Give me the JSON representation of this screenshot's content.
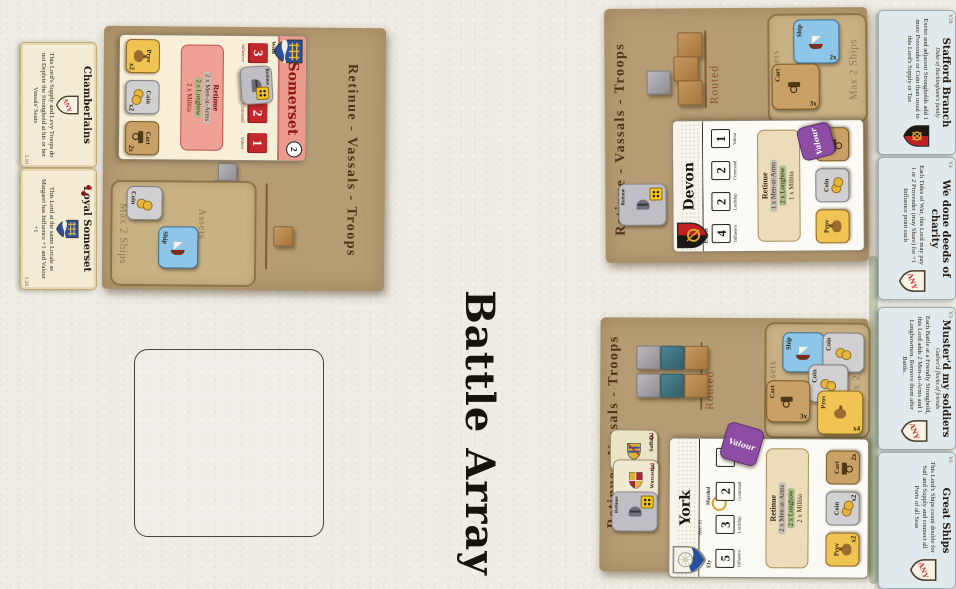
{
  "board": {
    "title": "Battle Array"
  },
  "shared": {
    "mat_header": "Retinue - Vassals - Troops",
    "routed": "Routed",
    "assets": "Assets",
    "max_ships": "Max 2 Ships",
    "stat_labels": [
      "Influence",
      "Lordship",
      "Command",
      "Valour"
    ],
    "retinue_label": "Retinue",
    "valour_label": "Valour"
  },
  "somerset": {
    "card": {
      "name": "Somerset",
      "seat": "Wells",
      "badge": "2",
      "stats": {
        "influence": "3",
        "command": "2",
        "valour": "1"
      },
      "retinue": [
        "2 x Men-at-Arms",
        "2 x Longbow",
        "2 x Militia"
      ],
      "tokens": [
        {
          "label": "Prov",
          "mult": "x2"
        },
        {
          "label": "Coin",
          "mult": "x2"
        },
        {
          "label": "Cart",
          "mult": "2x"
        }
      ]
    },
    "assets_tokens": [
      {
        "label": "Coin"
      },
      {
        "label": "Ship"
      }
    ]
  },
  "devon": {
    "card": {
      "name": "Devon",
      "seat": "Exeter",
      "stats": {
        "influence": "4",
        "lordship": "2",
        "command": "2",
        "valour": "1"
      },
      "retinue": [
        "1 x Men-at-Arms",
        "2 x Longbow",
        "1 x Militia"
      ],
      "tokens": [
        {
          "label": "Prov"
        },
        {
          "label": "Coin"
        },
        {
          "label": "Cart"
        }
      ]
    },
    "assets_tokens": [
      {
        "label": "Ship",
        "mult": "2x"
      },
      {
        "label": "Cart",
        "mult": "3x"
      }
    ]
  },
  "york": {
    "card": {
      "name": "York",
      "heir": "Heir #1",
      "seat": "Ely",
      "marshal": "Marshal",
      "stats": {
        "influence": "5",
        "lordship": "3",
        "command": "2"
      },
      "retinue": [
        "2 x Men-at-Arms",
        "2 x Longbow",
        "2 x Militia"
      ],
      "tokens": [
        {
          "label": "Prov",
          "mult": "x2"
        },
        {
          "label": "Coin",
          "mult": "x2"
        },
        {
          "label": "Cart",
          "mult": "2x"
        }
      ]
    },
    "assets_tokens": [
      {
        "label": "Ship"
      },
      {
        "label": "Coin"
      },
      {
        "label": "Coin",
        "mult": "x2"
      },
      {
        "label": "Cart",
        "mult": "3x"
      },
      {
        "label": "Prov",
        "mult": "x4"
      }
    ],
    "vassals": [
      {
        "name": "Suffolk",
        "value": "3"
      },
      {
        "name": "Worcester",
        "value": "3"
      }
    ]
  },
  "left_cards": [
    {
      "title": "Chamberlains",
      "shield": "ANY",
      "body": "This Lord's Supply and Levy Troops do not Deplete the Stronghold at his or her Vassals' Seats",
      "num": "L10"
    },
    {
      "title": "Loyal Somerset",
      "body": "This Lord at the same Locale as Margaret has Influence +1 and Valour +1",
      "num": "L28"
    }
  ],
  "right_cards": [
    {
      "title": "Stafford Branch",
      "subtitle": "Duke of Buckingham's family",
      "body": "Exeter and adjacent Strongholds add 1 more Provender or Coin than usual to this Lord's Supply or Tax",
      "num": "Y29"
    },
    {
      "title": "We done deeds of charity",
      "shield": "ANY",
      "body": "Each Tides of War, this Lord may pay 1 or 2 Provender (may Share) for +1 Influence point each",
      "num": "Y4"
    },
    {
      "title": "Muster'd my soldiers",
      "subtitle": "Gather'd flocks of friends",
      "shield": "ANY",
      "body": "Each Battle at a Friendly Stronghold, this Lord adds 2 Men-at-Arms and 1 Longbowmen. Remove them after Battle.",
      "num": "Y3"
    },
    {
      "title": "Great Ships",
      "shield": "ANY",
      "body": "This Lord's Ships count double for Sail and Supply and connect all Ports of all Seas",
      "num": "Y6"
    }
  ]
}
